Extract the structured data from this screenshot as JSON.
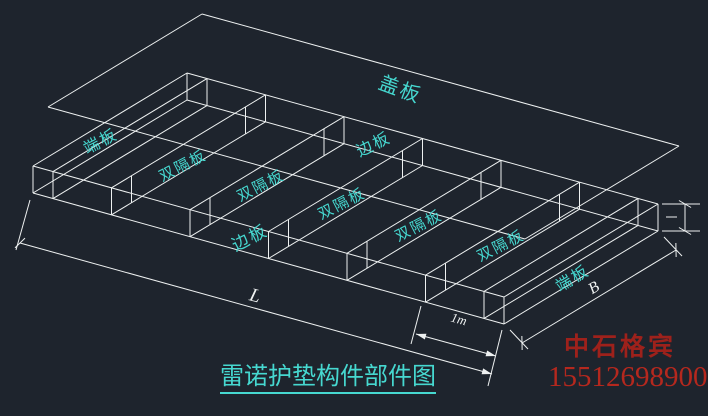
{
  "app": {
    "background": "#1e242d",
    "line_color": "#eef1f1",
    "label_color": "#46d8d0",
    "company_color": "#9e211b",
    "phone_color": "#b5281e"
  },
  "drawing": {
    "type": "cad-wireframe-isometric",
    "cover_plate": {
      "corners": [
        [
          48,
          107
        ],
        [
          202,
          14
        ],
        [
          679,
          146
        ],
        [
          525,
          239
        ]
      ]
    },
    "box": {
      "corner_left": [
        33,
        166
      ],
      "width_vector": [
        154,
        -93
      ],
      "length_vector": [
        471,
        131
      ],
      "height": 27,
      "cells": 6,
      "double_gap": 20
    },
    "labels": [
      {
        "text": "盖板",
        "x": 400,
        "y": 90,
        "rot": 20,
        "size": 20
      },
      {
        "text": "端板",
        "x": 101,
        "y": 142,
        "rot": -27,
        "size": 16
      },
      {
        "text": "双隔板",
        "x": 183,
        "y": 166,
        "rot": -27,
        "size": 15
      },
      {
        "text": "双隔板",
        "x": 261,
        "y": 186,
        "rot": -27,
        "size": 15
      },
      {
        "text": "双隔板",
        "x": 342,
        "y": 204,
        "rot": -27,
        "size": 15
      },
      {
        "text": "双隔板",
        "x": 419,
        "y": 226,
        "rot": -27,
        "size": 15
      },
      {
        "text": "双隔板",
        "x": 501,
        "y": 246,
        "rot": -27,
        "size": 15
      },
      {
        "text": "边板",
        "x": 374,
        "y": 145,
        "rot": -26,
        "size": 16
      },
      {
        "text": "边板",
        "x": 250,
        "y": 238,
        "rot": -27,
        "size": 17
      },
      {
        "text": "端板",
        "x": 573,
        "y": 279,
        "rot": -31,
        "size": 16
      }
    ],
    "dimensions": {
      "length": {
        "label": "L",
        "label_pos": [
          255,
          296
        ],
        "label_rot": 15,
        "label_size": 19,
        "line": [
          [
            20,
            243
          ],
          [
            492,
            374
          ]
        ],
        "ext": [
          [
            [
              30,
              200
            ],
            [
              16,
              250
            ]
          ],
          [
            [
              502,
              330
            ],
            [
              488,
              386
            ]
          ]
        ],
        "end_style": [
          "tick",
          "arrow"
        ]
      },
      "width": {
        "label": "B",
        "label_pos": [
          594,
          288
        ],
        "label_rot": -31,
        "label_size": 16,
        "line": [
          [
            522,
            343
          ],
          [
            676,
            250
          ]
        ],
        "ext": [
          [
            [
              510,
              330
            ],
            [
              528,
              349
            ]
          ],
          [
            [
              664,
              237
            ],
            [
              682,
              256
            ]
          ]
        ],
        "end_style": [
          "tick",
          "tick"
        ]
      },
      "cell": {
        "label": "1m",
        "label_pos": [
          459,
          319
        ],
        "label_rot": 15,
        "label_size": 13,
        "line": [
          [
            416,
            334
          ],
          [
            496,
            356
          ]
        ],
        "ext": [
          [
            [
              421,
              306
            ],
            [
              411,
              344
            ]
          ]
        ],
        "end_style": [
          "arrow",
          "arrow"
        ]
      },
      "height": {
        "label": "",
        "vline": [
          [
            685,
            204
          ],
          [
            685,
            231
          ]
        ],
        "ext": [
          [
            [
              662,
              204
            ],
            [
              700,
              204
            ]
          ],
          [
            [
              662,
              231
            ],
            [
              700,
              231
            ]
          ]
        ],
        "mid_tick": [
          [
            666,
            217
          ],
          [
            677,
            217
          ]
        ],
        "end_style": [
          "tick",
          "tick"
        ]
      }
    },
    "title": {
      "text": "雷诺护垫构件部件图"
    },
    "watermark": {
      "company": "中石格宾",
      "phone": "15512698900"
    }
  }
}
